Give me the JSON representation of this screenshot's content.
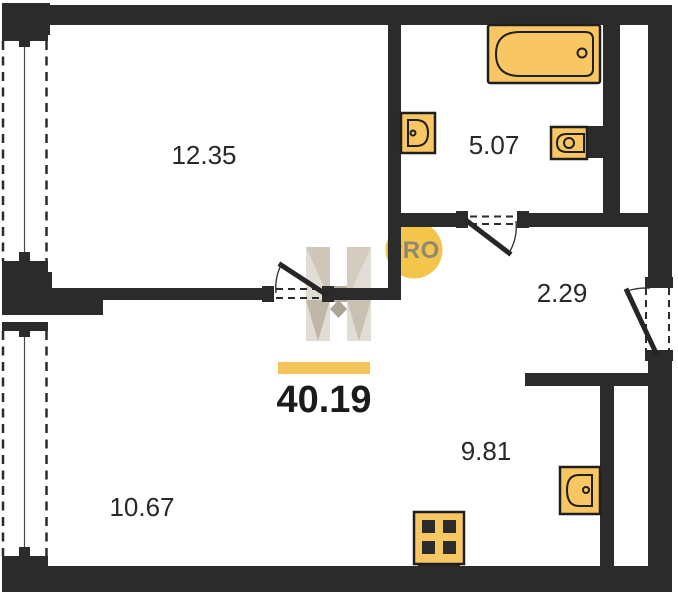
{
  "plan": {
    "areas": {
      "room_top": "12.35",
      "bathroom": "5.07",
      "hallway": "2.29",
      "kitchen": "9.81",
      "room_bottom": "10.67",
      "total": "40.19"
    },
    "logo": {
      "monogram": "H",
      "badge": "PRO"
    },
    "fixtures": [
      "bathtub",
      "wash-basin",
      "toilet",
      "kitchen-sink",
      "stove"
    ],
    "colors": {
      "wall": "#2b2b2b",
      "fixture": "#f8c763",
      "accent_bar": "#f5c45a",
      "logo_circle": "#f3c64b",
      "logo_text": "#8f8874",
      "watermark_base": "#e2ddd4",
      "label": "#282828"
    }
  }
}
